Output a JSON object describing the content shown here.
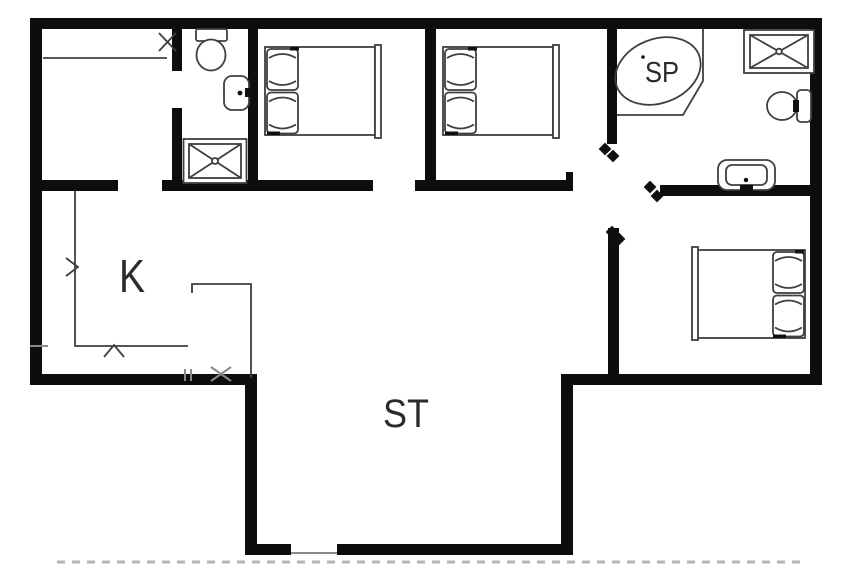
{
  "document": {
    "type": "floor-plan",
    "background": "#ffffff"
  },
  "labels": {
    "kitchen": "K",
    "living_room": "ST",
    "spa": "SP"
  },
  "rooms": [
    {
      "id": "entry-hall",
      "label": "",
      "fixtures": [
        "wardrobe-line",
        "door-cross-marker"
      ]
    },
    {
      "id": "bathroom-small",
      "label": "",
      "fixtures": [
        "toilet",
        "washbasin",
        "shower-cabin"
      ]
    },
    {
      "id": "bedroom-1",
      "label": "",
      "fixtures": [
        "double-bed"
      ]
    },
    {
      "id": "bedroom-2",
      "label": "",
      "fixtures": [
        "double-bed"
      ]
    },
    {
      "id": "spa-bathroom",
      "label": "SP",
      "fixtures": [
        "corner-spa-tub",
        "shower-cabin",
        "toilet",
        "washbasin"
      ]
    },
    {
      "id": "bedroom-3",
      "label": "",
      "fixtures": [
        "double-bed"
      ]
    },
    {
      "id": "kitchen",
      "label": "K",
      "fixtures": [
        "l-shaped-counter",
        "peninsula-counter",
        "hob-marker",
        "sink-marker"
      ]
    },
    {
      "id": "living-room",
      "label": "ST",
      "fixtures": [
        "terrace-door-opening"
      ]
    }
  ],
  "fixture_icons": {
    "double-bed": "rect-with-two-pillows",
    "toilet": "oval-bowl-with-tank",
    "washbasin": "rounded-rect-with-dot",
    "shower-cabin": "square-with-x-cross",
    "corner-spa-tub": "rotated-oval-in-corner-platform",
    "door-opening": "black-bowtie-marker",
    "window": "thin-tick-marks"
  },
  "palette": {
    "wall": "#0d0d0d",
    "fixture_line": "#3f3f3f",
    "window_marker": "#8a8a8a",
    "label_text": "#2b2b2b",
    "background": "#ffffff"
  }
}
